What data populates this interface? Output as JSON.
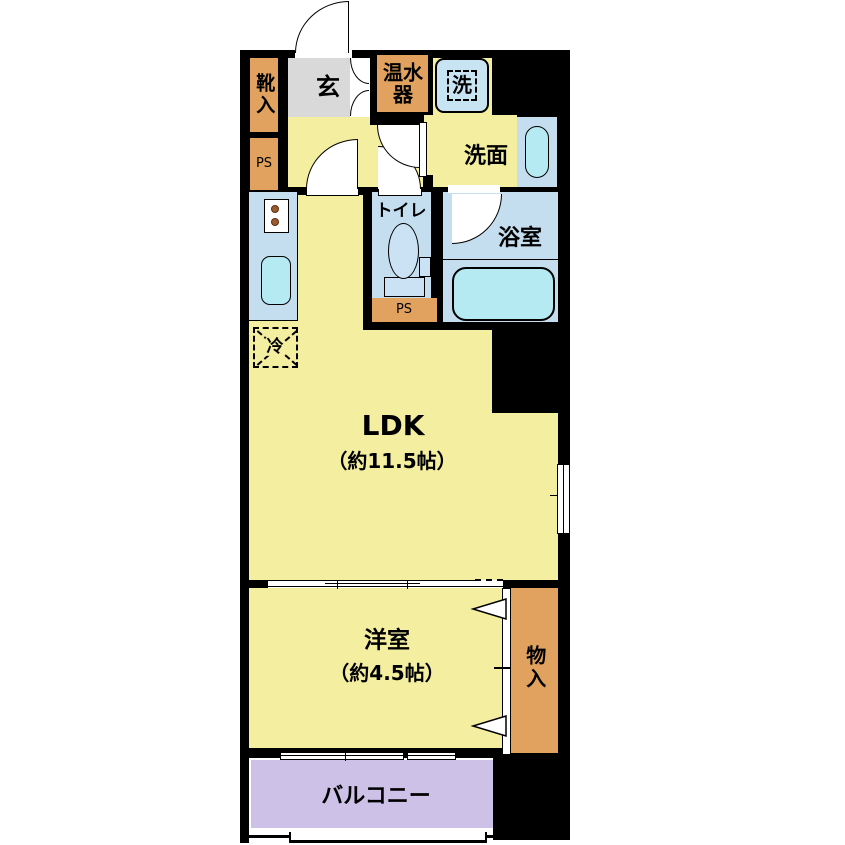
{
  "floorplan": {
    "title": "1LDK apartment floor plan",
    "rooms": {
      "shoe_storage": {
        "label": "靴入"
      },
      "entrance": {
        "label": "玄"
      },
      "pipe_space_upper": {
        "label": "PS"
      },
      "water_heater": {
        "label": "温水器"
      },
      "washing_machine": {
        "label": "洗"
      },
      "washroom": {
        "label": "洗面"
      },
      "toilet": {
        "label": "トイレ"
      },
      "pipe_space_lower": {
        "label": "PS"
      },
      "bathroom": {
        "label": "浴室"
      },
      "refrigerator": {
        "label": "冷"
      },
      "ldk": {
        "label": "LDK",
        "size": "（約11.5帖）"
      },
      "western_room": {
        "label": "洋室",
        "size": "（約4.5帖）"
      },
      "storage": {
        "label": "物入"
      },
      "balcony": {
        "label": "バルコニー"
      }
    },
    "colors": {
      "wall": "#000000",
      "room_yellow": "#F3EEA0",
      "service_orange": "#E0A25E",
      "entrance_gray": "#D9D9D9",
      "wet_area_blue": "#C5DEEF",
      "fixture_cyan": "#B5EAF2",
      "balcony_lavender": "#CDC1E8"
    }
  }
}
